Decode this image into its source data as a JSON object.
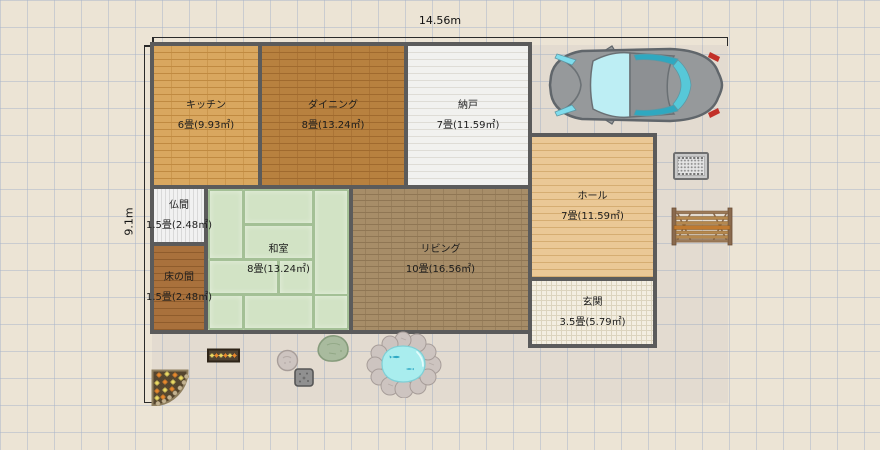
{
  "canvas": {
    "background_color": "#ece4d5",
    "grid_color": "#a8b4ca",
    "wall_color": "#5b5b5b"
  },
  "dimensions": {
    "width_label": "14.56m",
    "height_label": "9.1m"
  },
  "rooms": [
    {
      "id": "kitchen",
      "name": "キッチン",
      "size": "6畳(9.93㎡)",
      "floor_color": "#d9a75f"
    },
    {
      "id": "dining",
      "name": "ダイニング",
      "size": "8畳(13.24㎡)",
      "floor_color": "#b8813f"
    },
    {
      "id": "storage",
      "name": "納戸",
      "size": "7畳(11.59㎡)",
      "floor_color": "#f1f1ef"
    },
    {
      "id": "hall",
      "name": "ホール",
      "size": "7畳(11.59㎡)",
      "floor_color": "#eac896"
    },
    {
      "id": "butsuma",
      "name": "仏間",
      "size": "1.5畳(2.48㎡)",
      "floor_color": "#f1f1f1"
    },
    {
      "id": "washitsu",
      "name": "和室",
      "size": "8畳(13.24㎡)",
      "floor_color": "#cfe1c3"
    },
    {
      "id": "living",
      "name": "リビング",
      "size": "10畳(16.56㎡)",
      "floor_color": "#a78d68"
    },
    {
      "id": "tokonoma",
      "name": "床の間",
      "size": "1.5畳(2.48㎡)",
      "floor_color": "#a9713c"
    },
    {
      "id": "genkan",
      "name": "玄関",
      "size": "3.5畳(5.79㎡)",
      "floor_color": "#f3eee1"
    }
  ],
  "objects": [
    {
      "icon": "car-icon",
      "body_color": "#96999b",
      "window_color": "#b8ecf2"
    },
    {
      "icon": "doormat-icon",
      "color": "#c9c9c9"
    },
    {
      "icon": "bench-icon",
      "color": "#b5884e"
    },
    {
      "icon": "flower-bed-icon",
      "soil_color": "#55462f",
      "flower_colors": [
        "#e8882c",
        "#ead964"
      ]
    },
    {
      "icon": "flower-planter-icon",
      "soil_color": "#4e4232"
    },
    {
      "icon": "small-rock-icon",
      "color": "#c6bcb8"
    },
    {
      "icon": "stepping-stone-icon",
      "color": "#909090"
    },
    {
      "icon": "moss-rock-icon",
      "color": "#a9bb9e"
    },
    {
      "icon": "pond-icon",
      "water_color": "#a9edee",
      "stone_color": "#cdc4c0"
    }
  ]
}
